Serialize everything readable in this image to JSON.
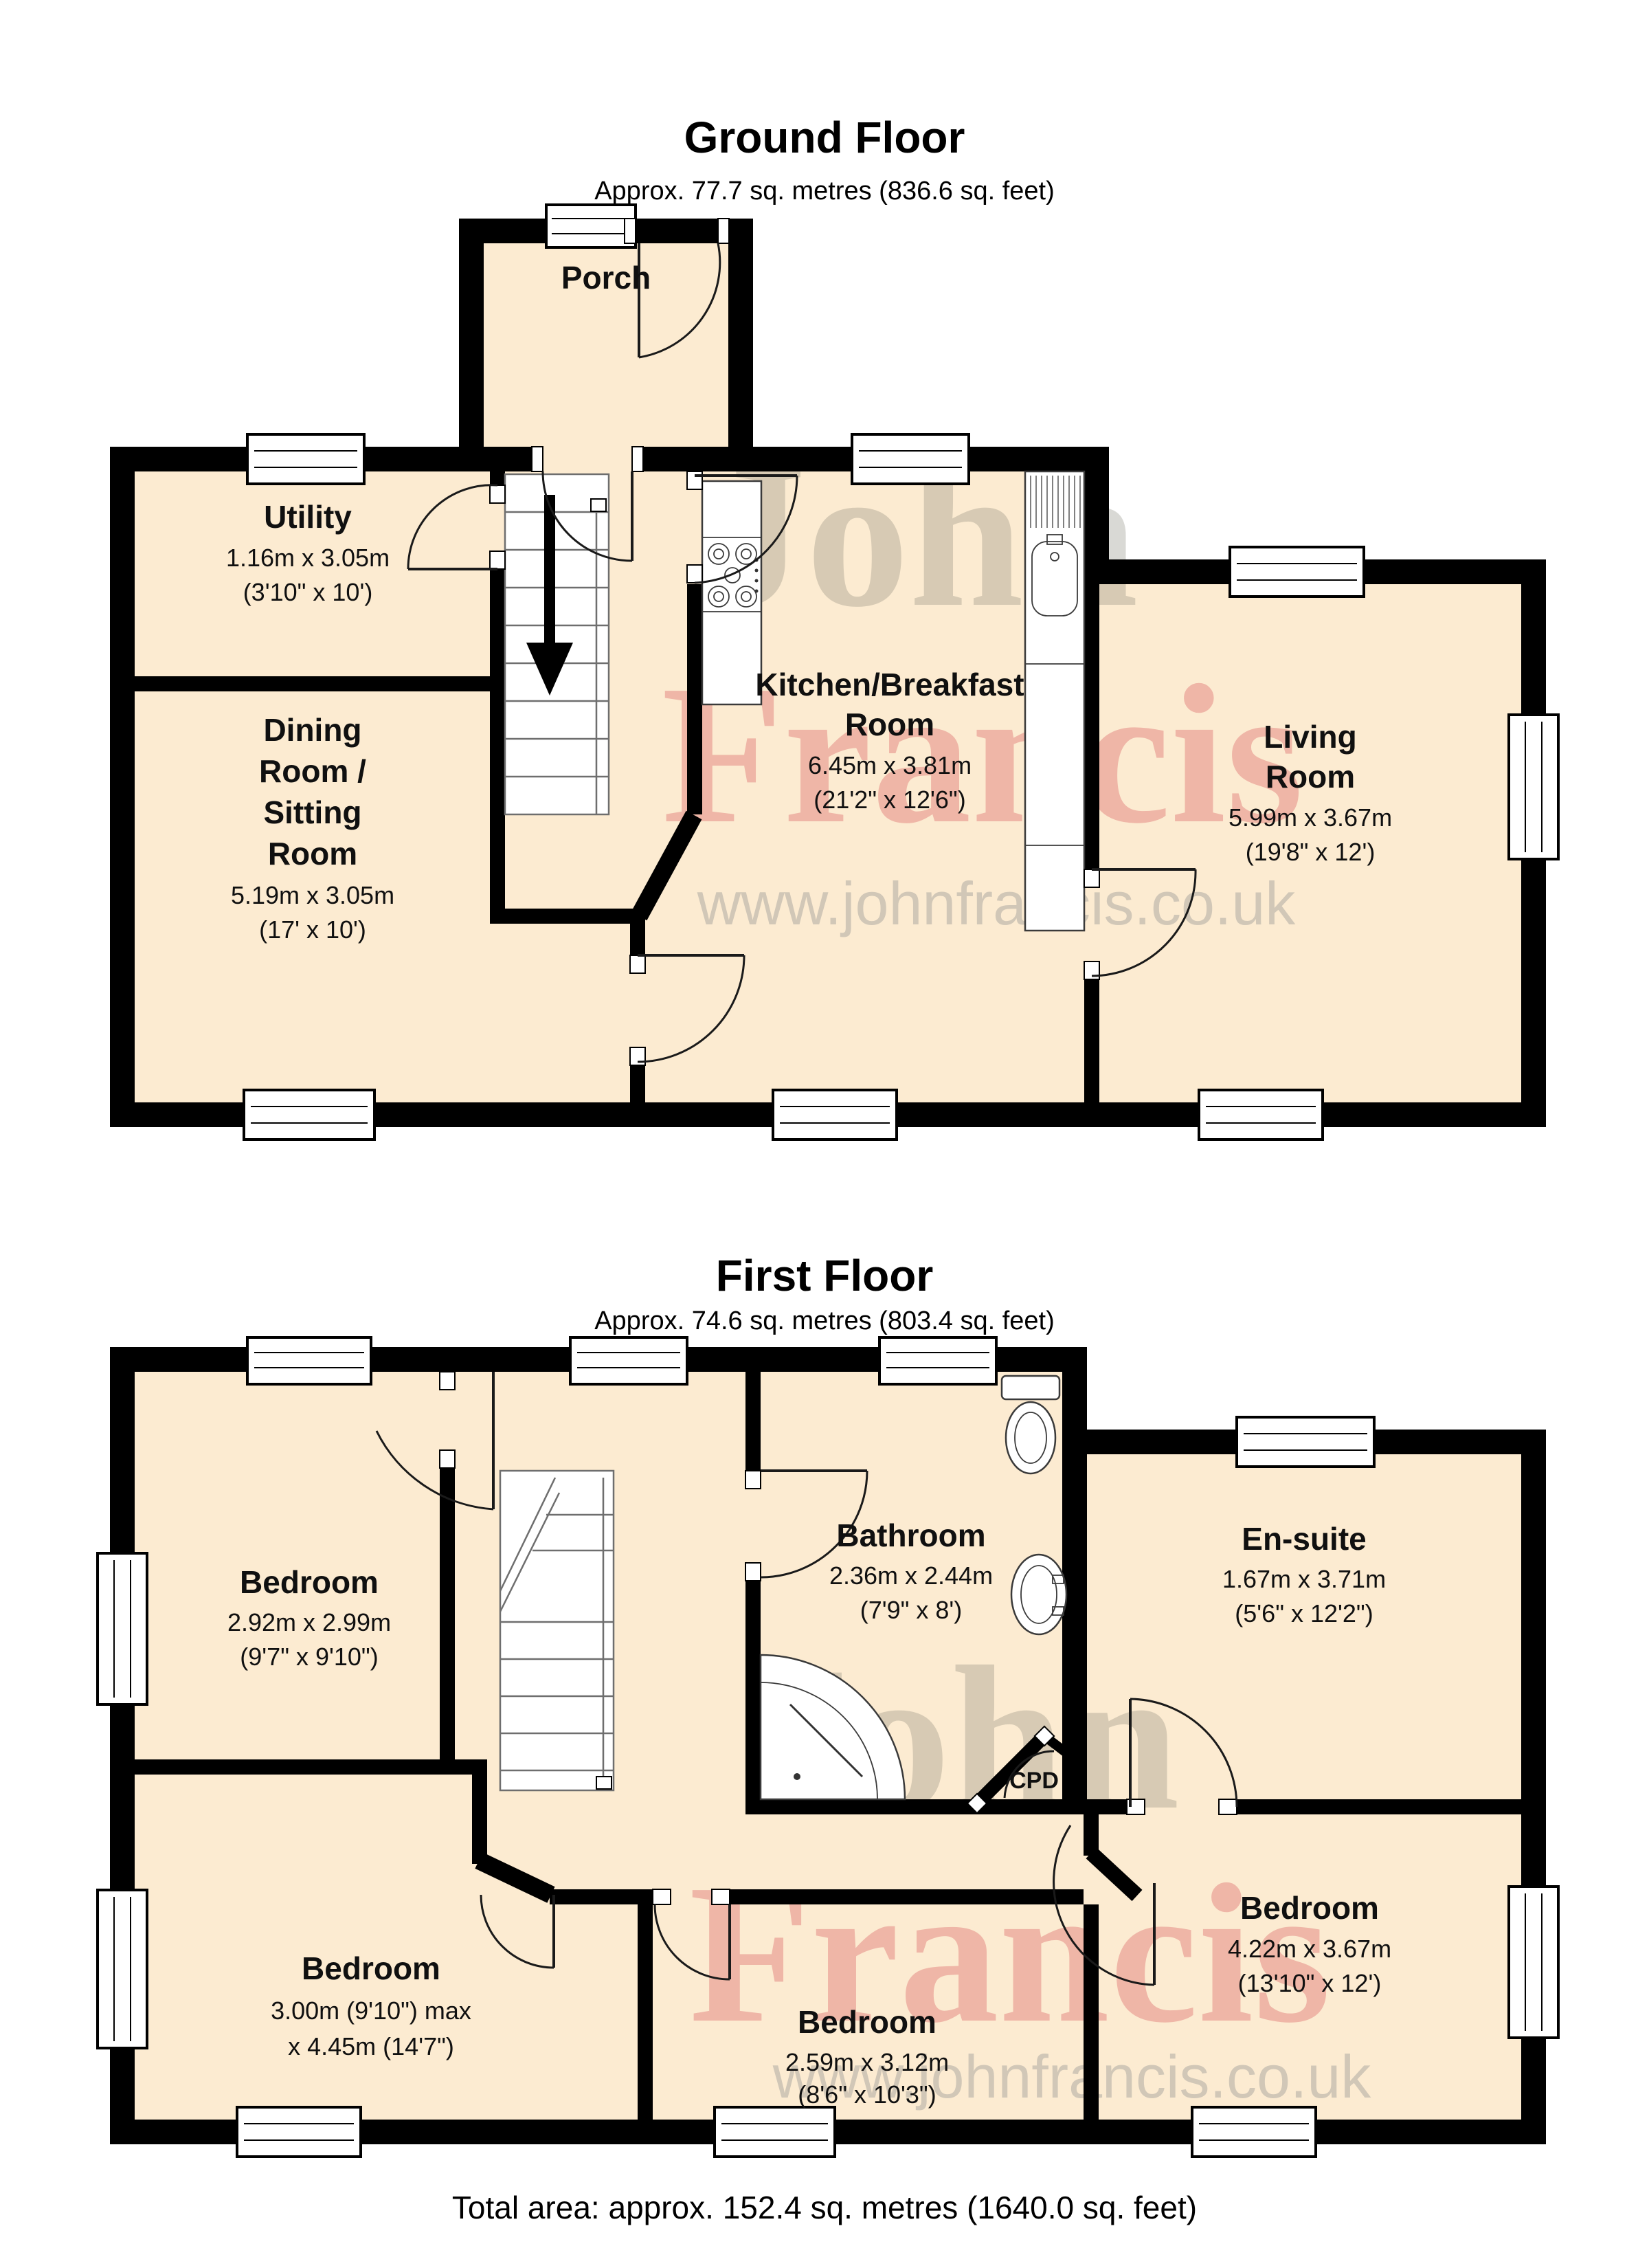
{
  "ground_floor": {
    "title": "Ground Floor",
    "subtitle": "Approx. 77.7 sq. metres (836.6 sq. feet)",
    "rooms": {
      "porch": {
        "name": "Porch"
      },
      "utility": {
        "name": "Utility",
        "dims_m": "1.16m x 3.05m",
        "dims_ft": "(3'10\" x 10')"
      },
      "dining": {
        "name_l1": "Dining",
        "name_l2": "Room /",
        "name_l3": "Sitting",
        "name_l4": "Room",
        "dims_m": "5.19m x 3.05m",
        "dims_ft": "(17' x 10')"
      },
      "kitchen": {
        "name_l1": "Kitchen/Breakfast",
        "name_l2": "Room",
        "dims_m": "6.45m x 3.81m",
        "dims_ft": "(21'2\" x 12'6\")"
      },
      "living": {
        "name_l1": "Living",
        "name_l2": "Room",
        "dims_m": "5.99m x 3.67m",
        "dims_ft": "(19'8\" x 12')"
      }
    }
  },
  "first_floor": {
    "title": "First Floor",
    "subtitle": "Approx. 74.6 sq. metres (803.4 sq. feet)",
    "rooms": {
      "bedroom_top_left": {
        "name": "Bedroom",
        "dims_m": "2.92m x 2.99m",
        "dims_ft": "(9'7\" x 9'10\")"
      },
      "bathroom": {
        "name": "Bathroom",
        "dims_m": "2.36m x 2.44m",
        "dims_ft": "(7'9\" x 8')"
      },
      "ensuite": {
        "name": "En-suite",
        "dims_m": "1.67m x 3.71m",
        "dims_ft": "(5'6\" x 12'2\")"
      },
      "cupboard": {
        "name": "CPD"
      },
      "bedroom_bottom_left": {
        "name": "Bedroom",
        "dims_l1": "3.00m (9'10\") max",
        "dims_l2": "x 4.45m (14'7\")"
      },
      "bedroom_bottom_middle": {
        "name": "Bedroom",
        "dims_m": "2.59m x 3.12m",
        "dims_ft": "(8'6\" x 10'3\")"
      },
      "bedroom_right": {
        "name": "Bedroom",
        "dims_m": "4.22m x 3.67m",
        "dims_ft": "(13'10\" x 12')"
      }
    }
  },
  "footer": {
    "total_area": "Total area: approx. 152.4 sq. metres (1640.0 sq. feet)"
  },
  "watermark": {
    "word1": "John",
    "word2": "Francis",
    "url": "www.johnfrancis.co.uk"
  },
  "colors": {
    "floor_fill": "#fcebd1",
    "wall": "#000000",
    "watermark_red": "#d23c46",
    "watermark_gray": "#787869",
    "url_gray": "#919191"
  }
}
